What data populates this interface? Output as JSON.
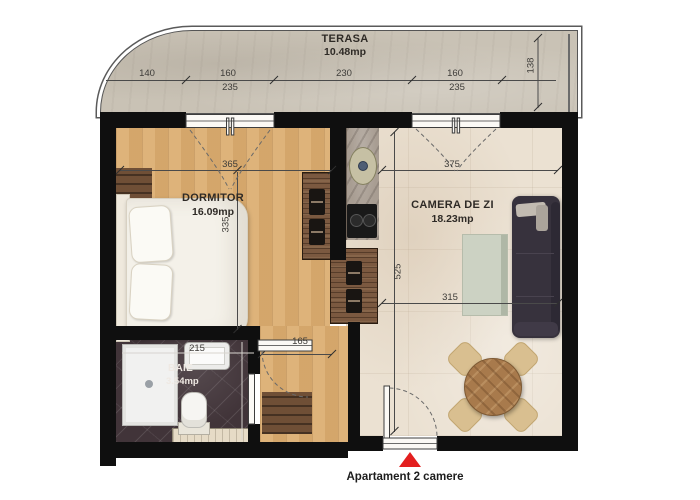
{
  "rooms": {
    "terasa": {
      "name": "TERASA",
      "area": "10.48mp"
    },
    "dormitor": {
      "name": "DORMITOR",
      "area": "16.09mp"
    },
    "camera_de_zi": {
      "name": "CAMERA DE ZI",
      "area": "18.23mp"
    },
    "baie": {
      "name": "BAIE",
      "area": "3.54mp"
    }
  },
  "dims": {
    "t140": "140",
    "t160a": "160",
    "t235a": "235",
    "t230": "230",
    "t160b": "160",
    "t235b": "235",
    "t138": "138",
    "d365": "365",
    "d335": "335",
    "d375": "375",
    "d525": "525",
    "d315": "315",
    "d215": "215",
    "d165": "165"
  },
  "footer": {
    "label": "Apartament 2 camere"
  },
  "colors": {
    "wall": "#0f0f0f",
    "terrace_floor": "#c9c2b5",
    "bedroom_floor": "#d9ab6f",
    "living_floor": "#ebe1d2",
    "bath_floor": "#413439",
    "kitchen_counter": "#a89d92",
    "dark_wood": "#7b5940",
    "sofa": "#37323d",
    "table_wood": "#a87a4c",
    "chair": "#d9bf90",
    "marker_red": "#e31f1f"
  }
}
